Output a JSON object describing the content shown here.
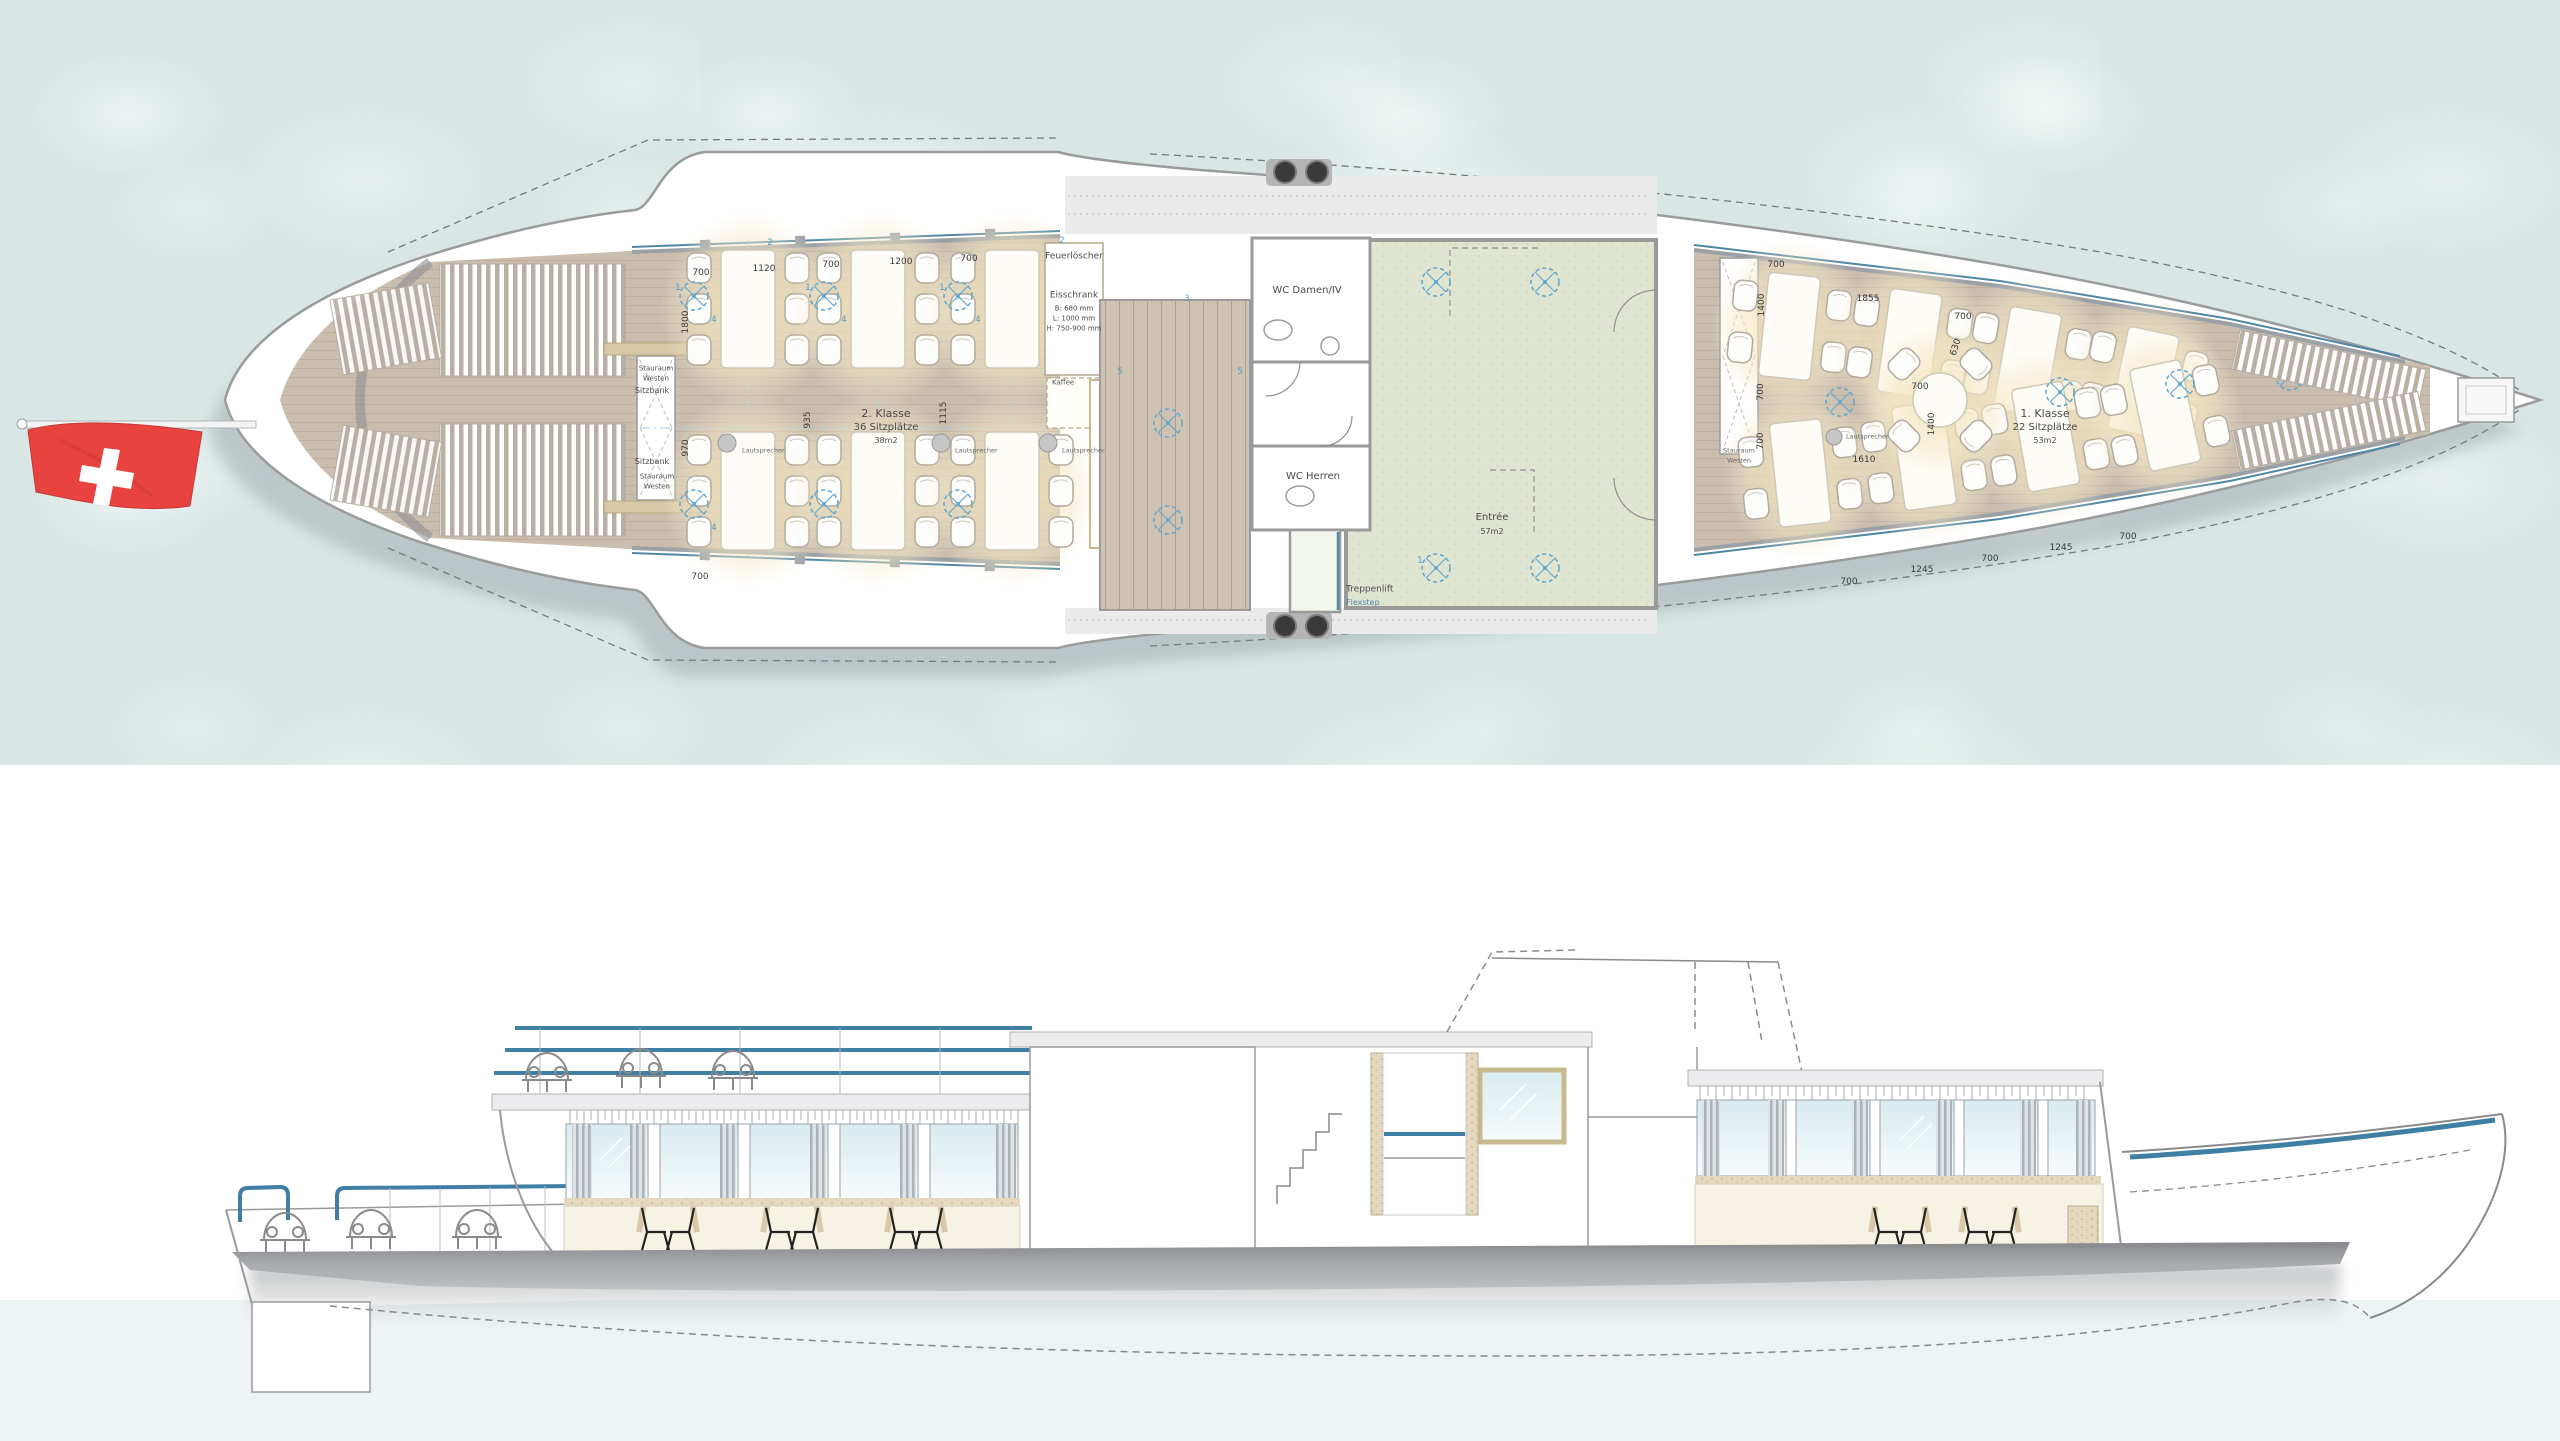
{
  "colors": {
    "water": "#d8e7e5",
    "wood": "#cabdae",
    "green_room": "#e0e5d2",
    "accent_blue": "#4f87a6",
    "lamp_blue": "#64a9cf",
    "flag_red": "#e8433f",
    "hull_gray": "#8b8d91"
  },
  "plan": {
    "class2": {
      "name": "2. Klasse",
      "seats": "36 Sitzplätze",
      "area": "38m2"
    },
    "class1": {
      "name": "1. Klasse",
      "seats": "22 Sitzplätze",
      "area": "53m2"
    },
    "entree": {
      "name": "Entrée",
      "area": "57m2"
    },
    "wc_damen": "WC Damen/IV",
    "wc_herren": "WC Herren",
    "treppenlift": {
      "name": "Treppenlift",
      "model": "Flexstep"
    },
    "feuerloescher": "Feuerlöscher",
    "eisschrank": {
      "name": "Eisschrank",
      "dim_b": "B: 680 mm",
      "dim_l": "L: 1000 mm",
      "dim_h": "H: 750-900 mm"
    },
    "kaffee": "Kaffee",
    "sitzbank": "Sitzbank",
    "stauraum_line1": "Stauraum",
    "stauraum_line2": "Westen",
    "lautsprecher": "Lautsprecher",
    "dims": {
      "d700": "700",
      "d1120": "1120",
      "d1200": "1200",
      "d1800": "1800",
      "d935": "935",
      "d1115": "1115",
      "d970": "970",
      "d1400": "1400",
      "d1855": "1855",
      "d630": "630",
      "d1610": "1610",
      "d1245": "1245"
    },
    "markers": {
      "m1": "1",
      "m2": "2",
      "m3": "3",
      "m4": "4",
      "m5": "5"
    }
  }
}
